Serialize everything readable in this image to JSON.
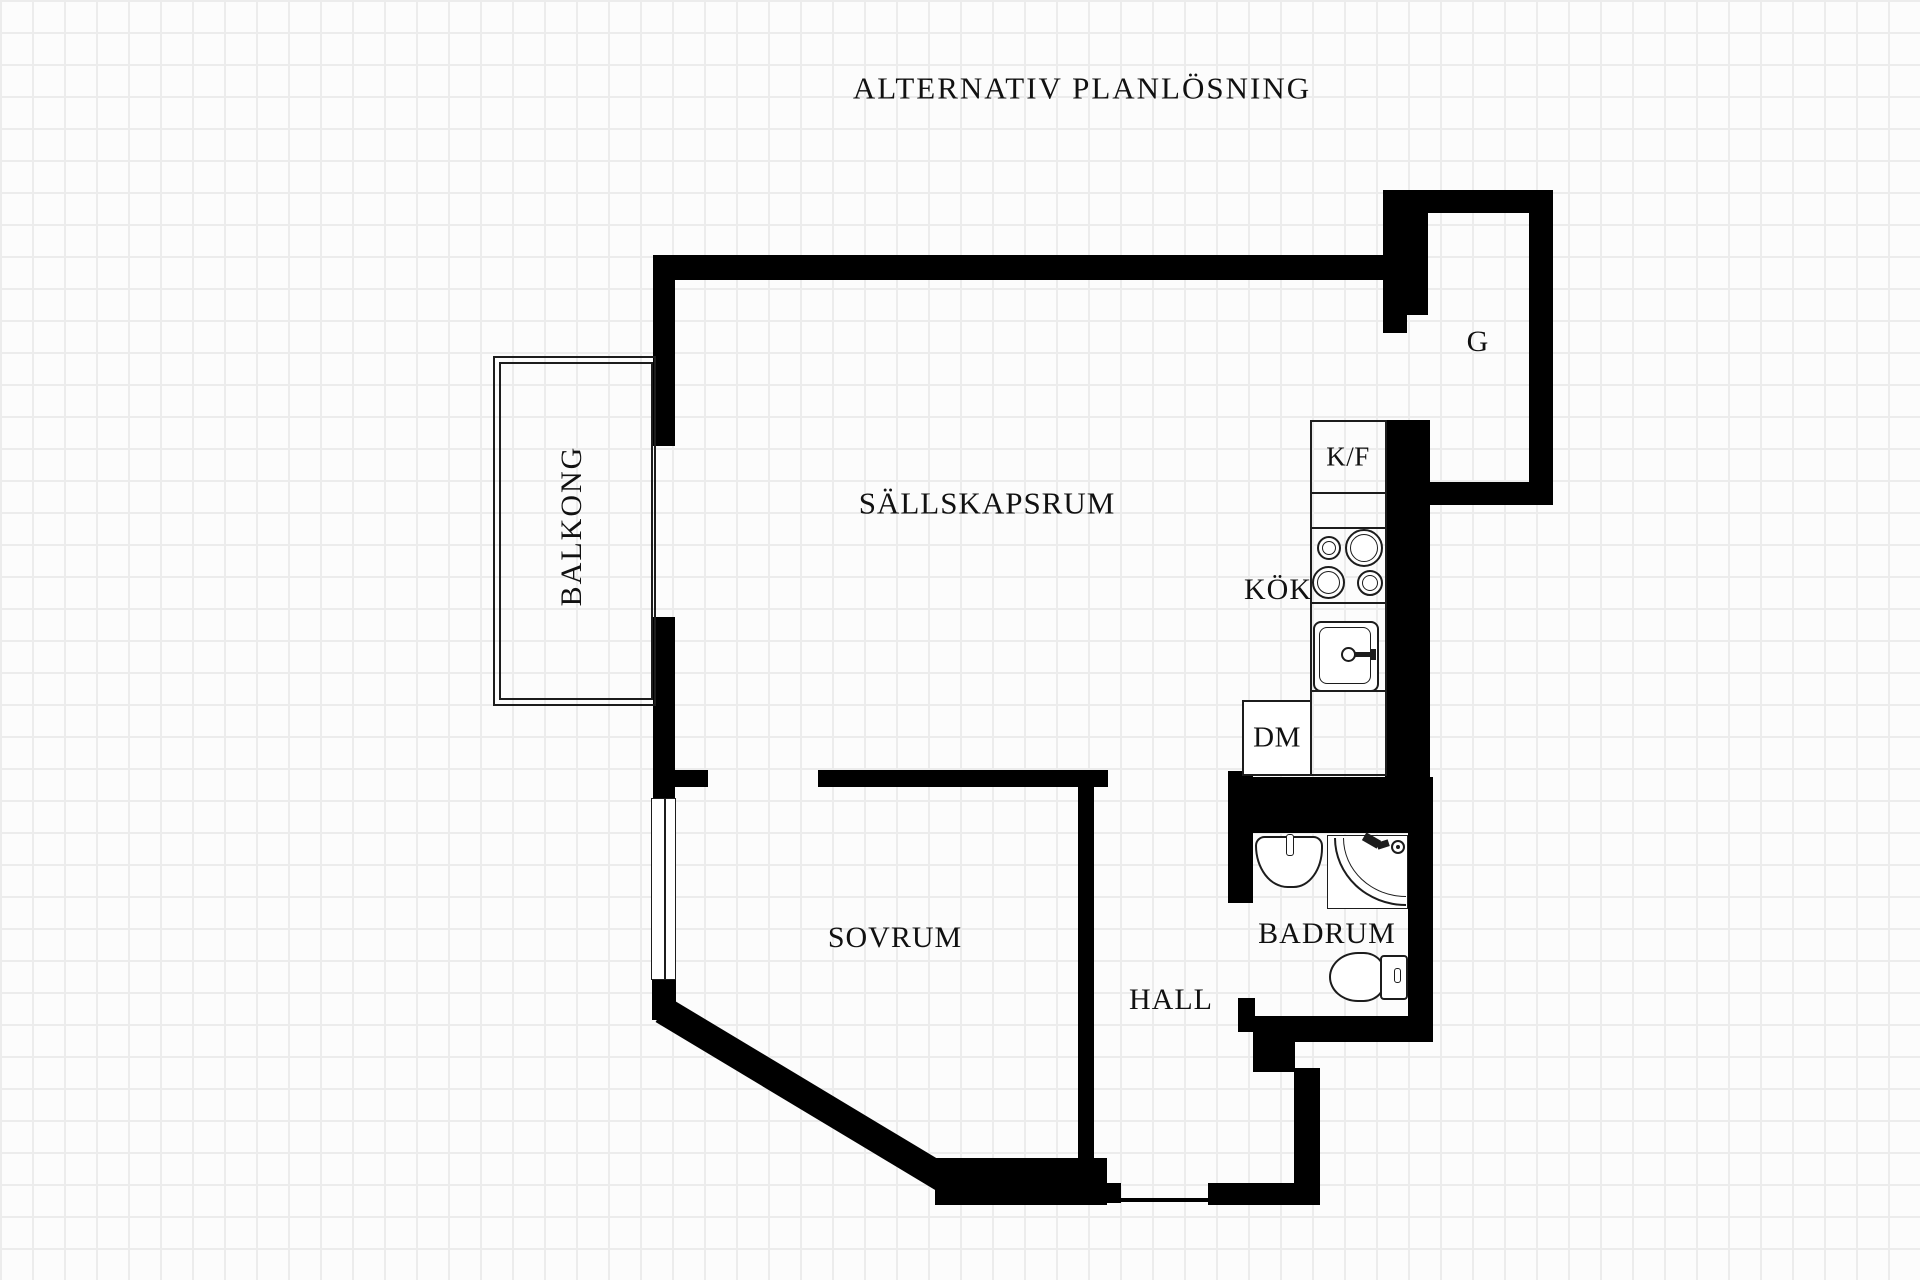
{
  "title": "ALTERNATIV PLANLÖSNING",
  "rooms": {
    "balcony": "BALKONG",
    "living": "SÄLLSKAPSRUM",
    "kitchen": "KÖK",
    "bedroom": "SOVRUM",
    "hall": "HALL",
    "bathroom": "BADRUM",
    "closet": "G"
  },
  "appliances": {
    "fridge_freezer": "K/F",
    "dishwasher": "DM"
  },
  "colors": {
    "wall": "#000000",
    "fixture_line": "#1c1c1c",
    "grid_line": "#ececec",
    "background": "#fcfcfc",
    "text": "#111111"
  }
}
